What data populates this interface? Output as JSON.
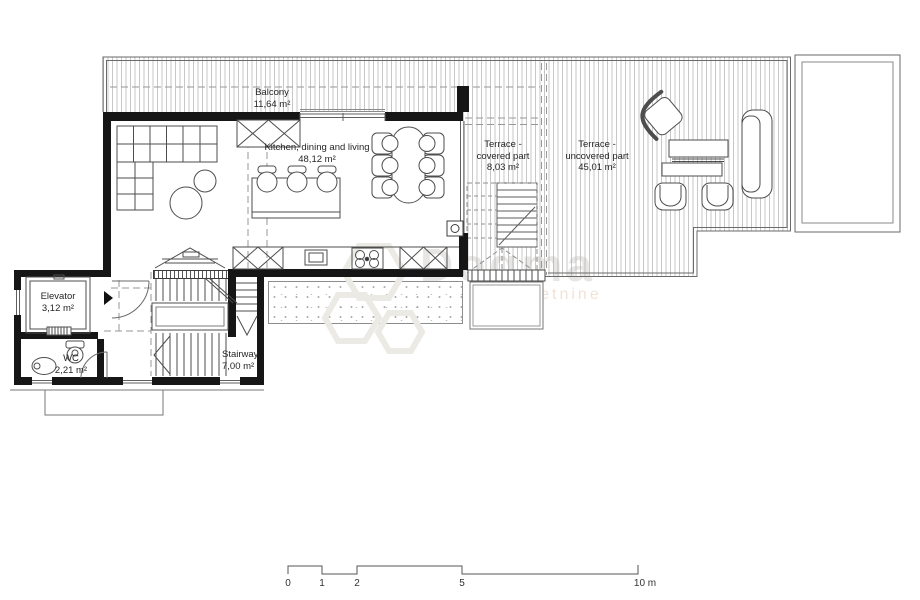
{
  "rooms": {
    "balcony": {
      "label": "Balcony",
      "area": "11,64 m²"
    },
    "living": {
      "label": "Kitchen, dining and living",
      "area": "48,12 m²"
    },
    "terrace_covered": {
      "l1": "Terrace -",
      "l2": "covered part",
      "area": "8,03 m²"
    },
    "terrace_uncovered": {
      "l1": "Terrace -",
      "l2": "uncovered part",
      "area": "45,01 m²"
    },
    "elevator": {
      "label": "Elevator",
      "area": "3,12 m²"
    },
    "wc": {
      "label": "WC",
      "area": "2,21 m²"
    },
    "stairway": {
      "label": "Stairway",
      "area": "7,00 m²"
    }
  },
  "scale": {
    "t0": "0",
    "t1": "1",
    "t2": "2",
    "t5": "5",
    "t10": "10 m"
  },
  "watermark": {
    "name": "Dogma",
    "tagline": "nekretnine"
  },
  "colors": {
    "wall": "#161616",
    "thin_line": "#6a6a6a",
    "decking": "#c7c7c7",
    "background": "#ffffff"
  }
}
